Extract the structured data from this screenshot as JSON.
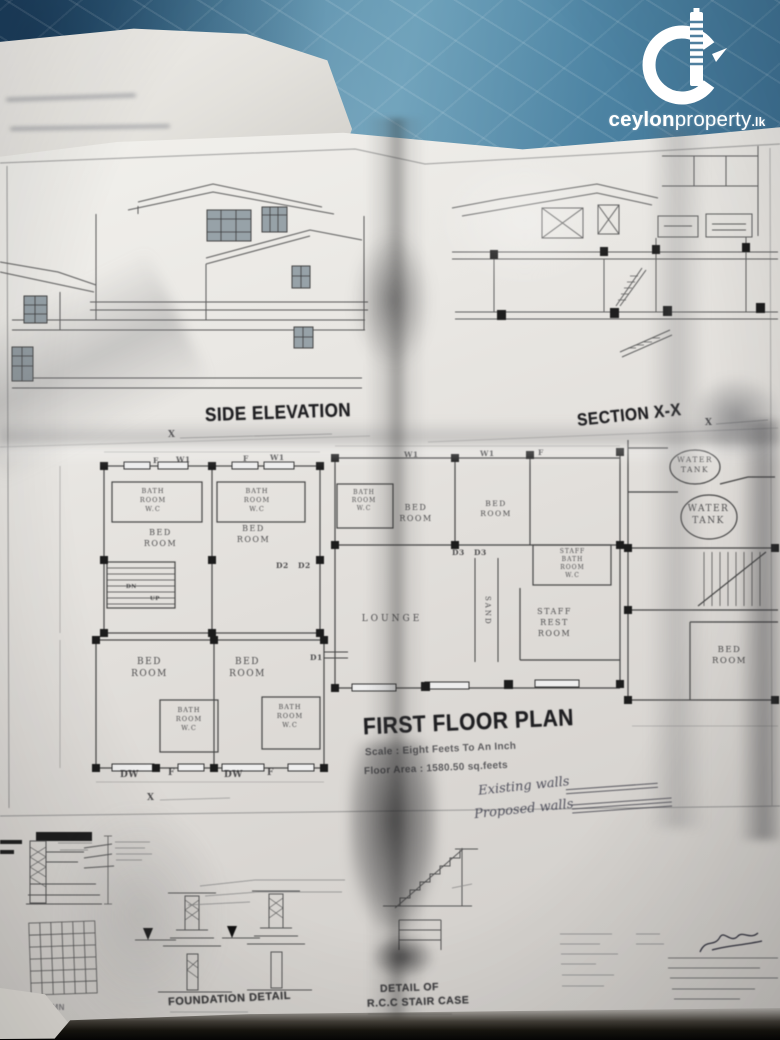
{
  "brand": {
    "bold": "ceylon",
    "light": "property",
    "tld": ".lk"
  },
  "titles": {
    "side_elevation": "SIDE ELEVATION",
    "section_xx": "SECTION X-X",
    "first_floor_plan": "FIRST FLOOR PLAN",
    "plan_scale": "Scale : Eight Feets To An Inch",
    "plan_area": "Floor Area : 1580.50 sq.feets",
    "foundation_detail": "FOUNDATION DETAIL",
    "stair_detail_line1": "DETAIL OF",
    "stair_detail_line2": "R.C.C STAIR CASE",
    "column_detail": "R.C.C COLUMN"
  },
  "handwriting": {
    "existing": "Existing walls",
    "proposed": "Proposed walls"
  },
  "rooms": {
    "bed": "BED",
    "room": "ROOM",
    "bath": "BATH",
    "wc": "W.C",
    "lounge": "LOUNGE",
    "staff": "STAFF",
    "rest": "REST",
    "water": "WATER",
    "tank": "TANK",
    "sand": "SAND"
  },
  "markers": {
    "f": "F",
    "w1": "W1",
    "d1": "D1",
    "d2": "D2",
    "d3": "D3",
    "dw": "DW",
    "x": "X",
    "up": "UP",
    "dn": "DN"
  }
}
